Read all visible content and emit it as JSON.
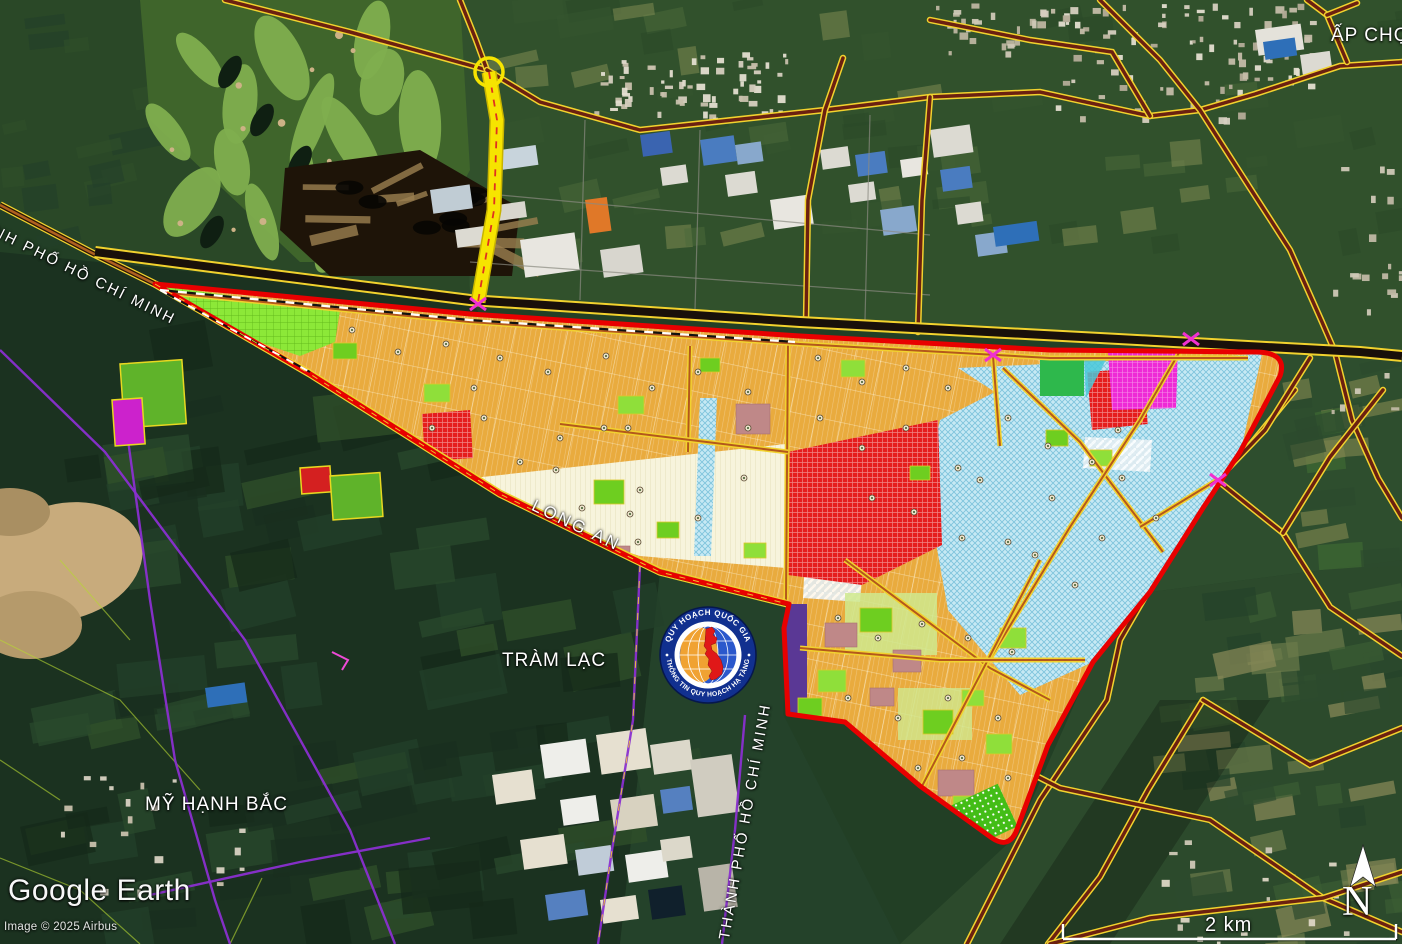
{
  "attribution": {
    "logo": "Google Earth",
    "copyright": "Image © 2025 Airbus"
  },
  "scale_bar": {
    "label": "2 km"
  },
  "compass": {
    "label": "N"
  },
  "labels": {
    "ap_cho": "ẤP CHỢ",
    "tram_lac": "TRÀM LẠC",
    "my_hanh_bac": "MỸ HẠNH BẮC",
    "long_an": "LONG AN",
    "tphcm_road": "THÀNH PHỐ HỒ CHÍ MINH",
    "tphcm_boundary": "THÀNH PHỐ HỒ CHÍ MINH"
  },
  "emblem": {
    "top_text": "QUY HOẠCH QUỐC GIA",
    "bottom_text": "THÔNG TIN QUY HOẠCH HẠ TẦNG"
  },
  "colors": {
    "plan_border": "#e80000",
    "parcel_orange": "#e9ab3e",
    "zone_red": "#e51d1d",
    "zone_blue": "#c6e9f4",
    "zone_lime": "#8ce838",
    "zone_magenta": "#ee2ad6",
    "zone_cream": "#f7f4dc",
    "zone_purple": "#5a3895",
    "road_yellow": "#f2d22e",
    "road_core": "#6b2010",
    "boundary_purple": "#8a2fd0",
    "highway_black": "#19100a"
  },
  "trees": [
    [
      352,
      330
    ],
    [
      398,
      352
    ],
    [
      446,
      344
    ],
    [
      500,
      358
    ],
    [
      548,
      372
    ],
    [
      606,
      356
    ],
    [
      652,
      388
    ],
    [
      698,
      372
    ],
    [
      748,
      392
    ],
    [
      818,
      358
    ],
    [
      862,
      382
    ],
    [
      906,
      368
    ],
    [
      948,
      388
    ],
    [
      628,
      428
    ],
    [
      560,
      438
    ],
    [
      484,
      418
    ],
    [
      520,
      462
    ],
    [
      582,
      508
    ],
    [
      640,
      490
    ],
    [
      698,
      518
    ],
    [
      744,
      478
    ],
    [
      820,
      418
    ],
    [
      862,
      448
    ],
    [
      906,
      428
    ],
    [
      872,
      498
    ],
    [
      914,
      512
    ],
    [
      958,
      468
    ],
    [
      1008,
      418
    ],
    [
      1052,
      498
    ],
    [
      1102,
      538
    ],
    [
      1008,
      542
    ],
    [
      962,
      538
    ],
    [
      838,
      618
    ],
    [
      878,
      638
    ],
    [
      922,
      624
    ],
    [
      968,
      638
    ],
    [
      1012,
      652
    ],
    [
      848,
      698
    ],
    [
      898,
      718
    ],
    [
      948,
      698
    ],
    [
      998,
      718
    ],
    [
      868,
      758
    ],
    [
      918,
      768
    ],
    [
      962,
      758
    ],
    [
      1008,
      778
    ],
    [
      888,
      808
    ],
    [
      938,
      818
    ],
    [
      748,
      428
    ],
    [
      638,
      542
    ],
    [
      604,
      428
    ],
    [
      1122,
      478
    ],
    [
      1156,
      518
    ],
    [
      474,
      388
    ],
    [
      432,
      428
    ],
    [
      556,
      470
    ],
    [
      630,
      514
    ],
    [
      1048,
      446
    ],
    [
      1092,
      462
    ],
    [
      1118,
      430
    ],
    [
      980,
      480
    ],
    [
      1035,
      555
    ],
    [
      1075,
      585
    ]
  ]
}
